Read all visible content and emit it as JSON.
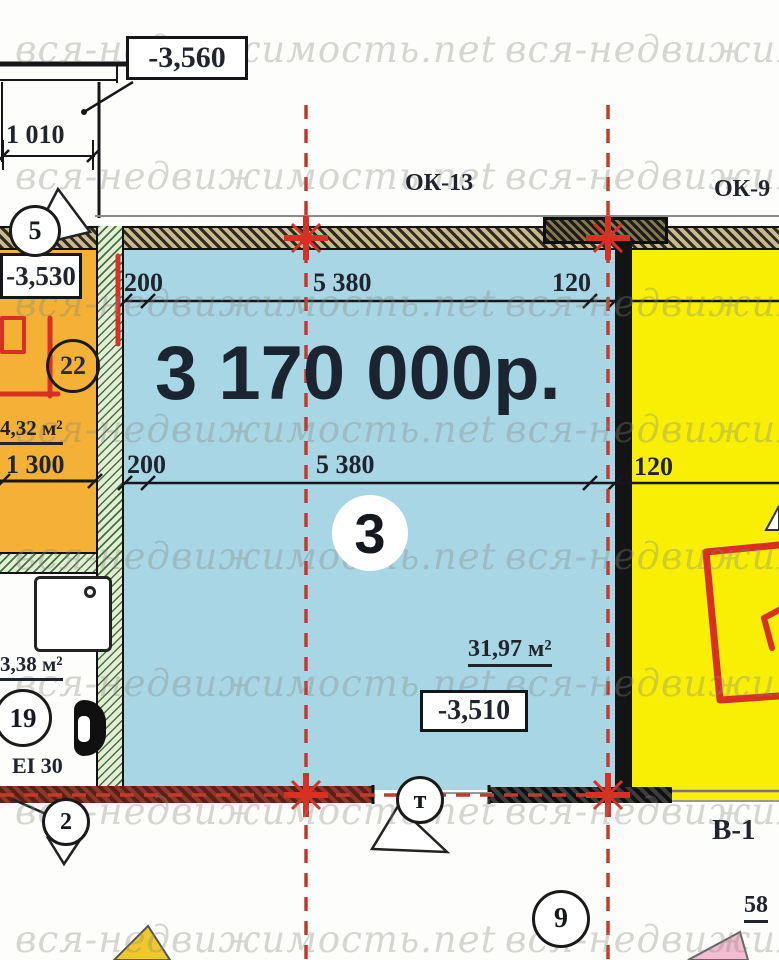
{
  "watermark": {
    "text": "вся-недвижимость.net"
  },
  "price": "3 170 000р.",
  "windows": {
    "ok13": "ОК-13",
    "ok9": "ОК-9"
  },
  "elevations": {
    "outside": "-3,560",
    "left_room": "-3,530",
    "main_room": "-3,510"
  },
  "rooms": {
    "main": {
      "number": "3",
      "area": "31,97 м²"
    },
    "left": {
      "number": "22",
      "area": "4,32 м²"
    },
    "bathroom": {
      "number": "19",
      "area": "3,38 м²"
    }
  },
  "dimensions": {
    "top_row": {
      "left": "200",
      "middle": "5 380",
      "right": "120"
    },
    "mid_row": {
      "left": "200",
      "middle": "5 380",
      "right": "120"
    },
    "door_width": "1 010",
    "left_width": "1 300",
    "bottom_right": "58"
  },
  "axis_markers": {
    "left_top": "5",
    "bottom_left": "2",
    "bottom_middle": "т",
    "bottom_right": "9"
  },
  "labels": {
    "beam": "В-1",
    "fire_rating": "EI 30"
  },
  "colors": {
    "main_room_fill": "#a9d6e5",
    "right_room_fill": "#f8ef04",
    "left_room_fill": "#f4b136",
    "marker_red": "#d93025",
    "axis_red": "#c23b2e"
  }
}
